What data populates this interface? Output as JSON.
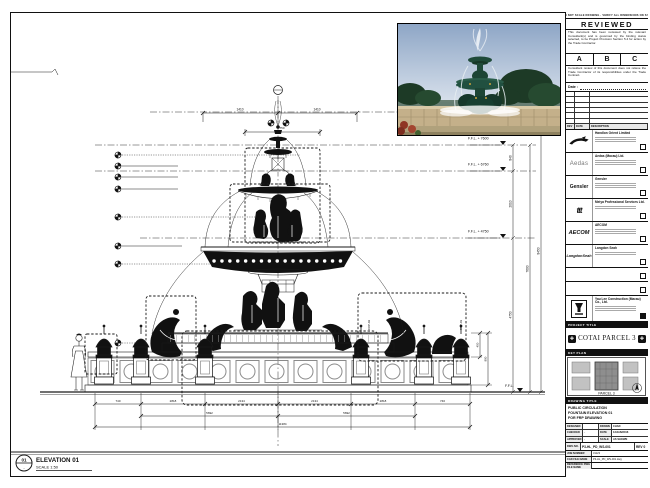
{
  "doc": {
    "top_note": "DO NOT SCALE DRAWING · VERIFY ALL DIMENSIONS ON SITE"
  },
  "stamp": {
    "title": "REVIEWED",
    "para1": "This document has been reviewed by the relevant Consultant(s) and is governed by the binding status selected, to be Project Provision Section 5.4 for action by the Trade Contractor.",
    "grades": [
      "A",
      "B",
      "C"
    ],
    "para2": "Consultant review of this document does not relieve the Trade Contractor of its responsibilities under the Trade Contract.",
    "date_label": "Date :"
  },
  "revtable": {
    "headers": [
      "REV",
      "DATE",
      "DESCRIPTION"
    ]
  },
  "companies": [
    {
      "logo": "",
      "name": "Handlon Orient Limited"
    },
    {
      "logo": "Aedas",
      "name": "Aedas (Macau) Ltd."
    },
    {
      "logo": "Gensler",
      "name": "Gensler"
    },
    {
      "logo": "ttt",
      "name": "Meiya Professional Services Ltd."
    },
    {
      "logo": "AECOM",
      "name": "AECOM"
    },
    {
      "logo": "LangdonSeah",
      "name": "Langdon Seah"
    }
  ],
  "contractor": {
    "name": "Yau Lee Construction (Macau) Co., Ltd."
  },
  "project": {
    "band": "PROJECT TITLE",
    "name": "COTAI PARCEL 3"
  },
  "keyplan": {
    "band": "KEY PLAN",
    "note": "PARCEL 3"
  },
  "drawing_title": {
    "band": "DRAWING TITLE",
    "line1": "PUBLIC CIRCULATION",
    "line2": "FOUNTAIN ELEVATION 01",
    "line3": "FOR FRP DRAWING"
  },
  "fields": {
    "designed_label": "DESIGNED",
    "designed": "",
    "drawn_label": "DRAWN",
    "drawn": "CHAD",
    "checked_label": "CHECKED",
    "checked": "-",
    "date_label": "DATE",
    "date": "12/JAN/2016",
    "approved_label": "APPROVED",
    "approved": "-",
    "scale_label": "SCALE",
    "scale": "AS SHOWN"
  },
  "refs": {
    "dwg_label": "DWG NO.",
    "dwg_no": "P3-HL_PD_WS-001",
    "rev": "REV 0",
    "job_label": "JOB NUMBER",
    "job_no": "31123",
    "cad_label": "CAD FILE NAME",
    "cad_file": "P3-HL_PD_WS-001.dwg",
    "ref_label": "REFERENCE DWG FILE NAME",
    "ref_file": ""
  },
  "elevation": {
    "tag_top": "01",
    "tag_bottom": "-",
    "label": "ELEVATION 01",
    "scale": "SCALE  1:50"
  },
  "levels": {
    "l1": "F.F.L. + 7600",
    "l2": "F.F.L. + 6760",
    "l3": "F.F.L. + 4750",
    "base": "F.F.L."
  },
  "dims": {
    "top_left": "1410",
    "top_right": "1410",
    "pkg": "750",
    "right_1": "840",
    "right_2": "2010",
    "right_3": "4750",
    "right_4": "7600",
    "right_5": "8450",
    "bottom": [
      "740",
      "2818",
      "2134",
      "2134",
      "2818",
      "740"
    ],
    "mid": [
      "5692",
      "5692"
    ],
    "total": "11384",
    "lamp_1": "450",
    "lamp_2": "890"
  },
  "notes": {
    "frp_a": "FRP-02",
    "frp_b": "FRP-03"
  }
}
